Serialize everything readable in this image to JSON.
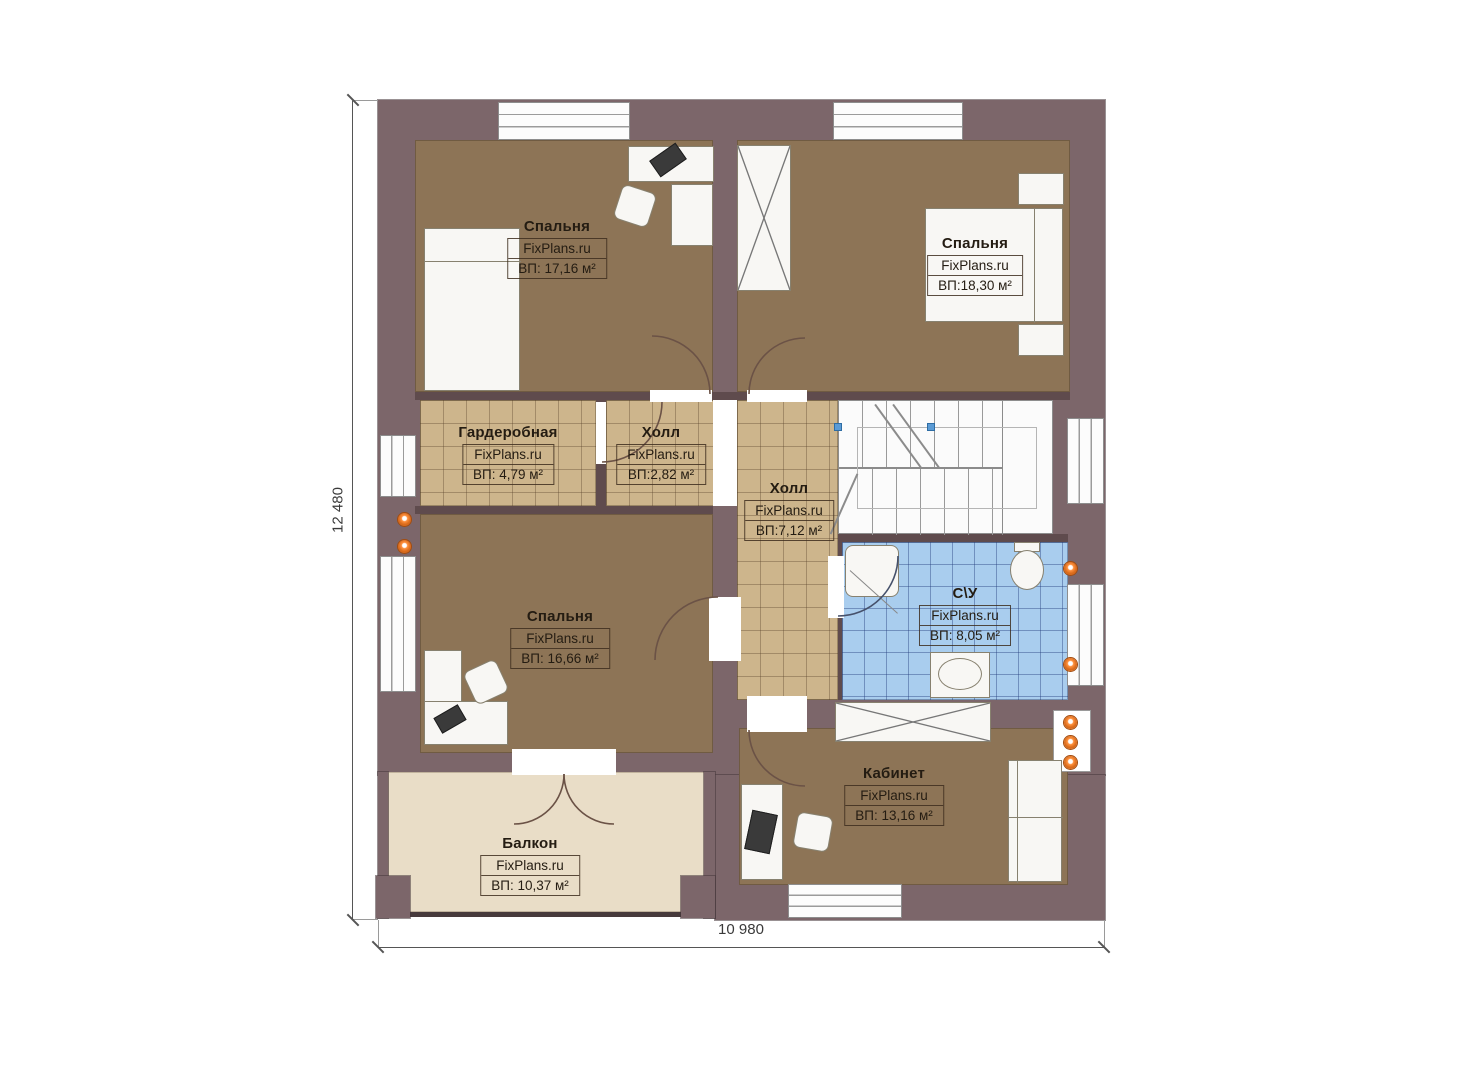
{
  "plan": {
    "brand": "FixPlans.ru",
    "rooms": [
      {
        "id": "bedroom-top-left",
        "name": "Спальня",
        "brand": "FixPlans.ru",
        "area": "ВП: 17,16 м²"
      },
      {
        "id": "bedroom-top-right",
        "name": "Спальня",
        "brand": "FixPlans.ru",
        "area": "ВП:18,30 м²"
      },
      {
        "id": "wardrobe-room",
        "name": "Гардеробная",
        "brand": "FixPlans.ru",
        "area": "ВП: 4,79 м²"
      },
      {
        "id": "hall-small",
        "name": "Холл",
        "brand": "FixPlans.ru",
        "area": "ВП:2,82 м²"
      },
      {
        "id": "hall-main",
        "name": "Холл",
        "brand": "FixPlans.ru",
        "area": "ВП:7,12 м²"
      },
      {
        "id": "bathroom",
        "name": "С\\У",
        "brand": "FixPlans.ru",
        "area": "ВП: 8,05 м²"
      },
      {
        "id": "bedroom-bottom-left",
        "name": "Спальня",
        "brand": "FixPlans.ru",
        "area": "ВП: 16,66 м²"
      },
      {
        "id": "office",
        "name": "Кабинет",
        "brand": "FixPlans.ru",
        "area": "ВП: 13,16 м²"
      },
      {
        "id": "balcony",
        "name": "Балкон",
        "brand": "FixPlans.ru",
        "area": "ВП: 10,37 м²"
      }
    ],
    "dimensions": {
      "height": "12 480",
      "width": "10 980"
    },
    "colors": {
      "wall": "#7c666a",
      "partition": "#5f4b4d",
      "floor_wood": "#8d7456",
      "floor_tile_tan": "#cdb58c",
      "floor_tile_blue": "#a9cdee",
      "balcony_floor": "#e9ddc7",
      "radiator_dot": "#f08030",
      "stair_marker": "#5b9bd5"
    }
  }
}
